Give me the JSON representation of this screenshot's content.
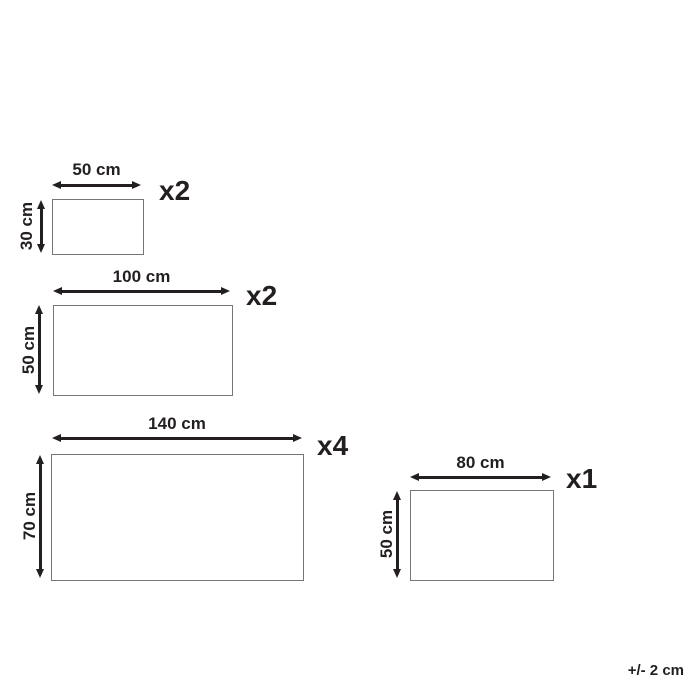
{
  "colors": {
    "ink": "#231f20",
    "rect_border": "#767676",
    "background": "#ffffff"
  },
  "panels": [
    {
      "id": "50x30",
      "width_label": "50 cm",
      "height_label": "30 cm",
      "quantity_label": "x2",
      "width_cm": 50,
      "height_cm": 30,
      "quantity": 2
    },
    {
      "id": "100x50",
      "width_label": "100 cm",
      "height_label": "50 cm",
      "quantity_label": "x2",
      "width_cm": 100,
      "height_cm": 50,
      "quantity": 2
    },
    {
      "id": "140x70",
      "width_label": "140 cm",
      "height_label": "70 cm",
      "quantity_label": "x4",
      "width_cm": 140,
      "height_cm": 70,
      "quantity": 4
    },
    {
      "id": "80x50",
      "width_label": "80 cm",
      "height_label": "50 cm",
      "quantity_label": "x1",
      "width_cm": 80,
      "height_cm": 50,
      "quantity": 1
    }
  ],
  "tolerance_note": "+/- 2 cm"
}
